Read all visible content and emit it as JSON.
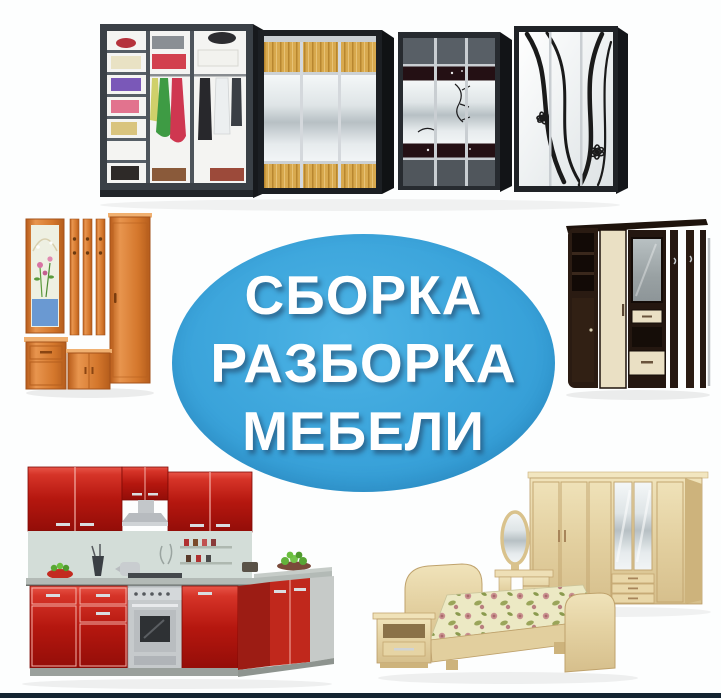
{
  "poster": {
    "background_color": "#fdfefe",
    "badge": {
      "lines": [
        "СБОРКА",
        "РАЗБОРКА",
        "МЕБЕЛИ"
      ],
      "bg_color": "#3aa3da",
      "text_color": "#ffffff"
    },
    "bottom_bar_color": "#132330",
    "photos": [
      {
        "name": "wardrobes-photo",
        "subject": "four sliding-door wardrobes in a row"
      },
      {
        "name": "hallway-orange-photo",
        "subject": "orange hallway set with framed mirror, coat-hook slats and cabinets"
      },
      {
        "name": "hallway-dark-photo",
        "subject": "dark wenge hallway unit with cream doors, mirror and coat rack"
      },
      {
        "name": "kitchen-photo",
        "subject": "red L-shaped kitchen with steel stove and hood"
      },
      {
        "name": "bedroom-photo",
        "subject": "light beech bedroom set: bed with floral cover, nightstand, dressing table, mirrored wardrobe"
      }
    ],
    "accent_colors": {
      "kitchen_red": "#b5170f",
      "hallway_orange": "#d4772c",
      "hallway_wenge": "#2a1b12",
      "bedroom_beech": "#e3d0a0",
      "wardrobe_wood": "#d8a94e"
    }
  }
}
